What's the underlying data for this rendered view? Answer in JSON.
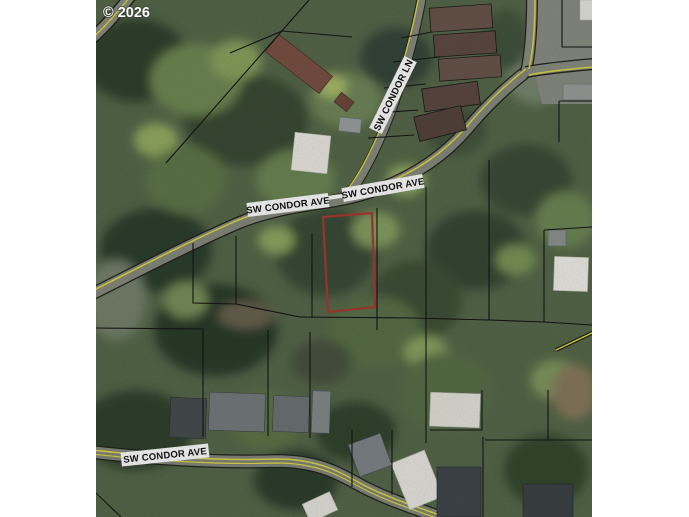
{
  "map": {
    "copyright": "© 2026",
    "street_labels": {
      "condor_ave_left": {
        "text": "SW CONDOR AVE"
      },
      "condor_ave_right": {
        "text": "SW CONDOR AVE"
      },
      "condor_ln": {
        "text": "SW CONDOR LN"
      },
      "condor_ave_bottom": {
        "text": "SW CONDOR AVE"
      }
    },
    "colors": {
      "highlight_parcel": "#a83b31",
      "parcel_line": "#161616",
      "road_paint_yellow": "#e0d844",
      "road_surface": "#878b7e",
      "foliage_base": "#57694b",
      "margin_background": "#ffffff"
    }
  }
}
